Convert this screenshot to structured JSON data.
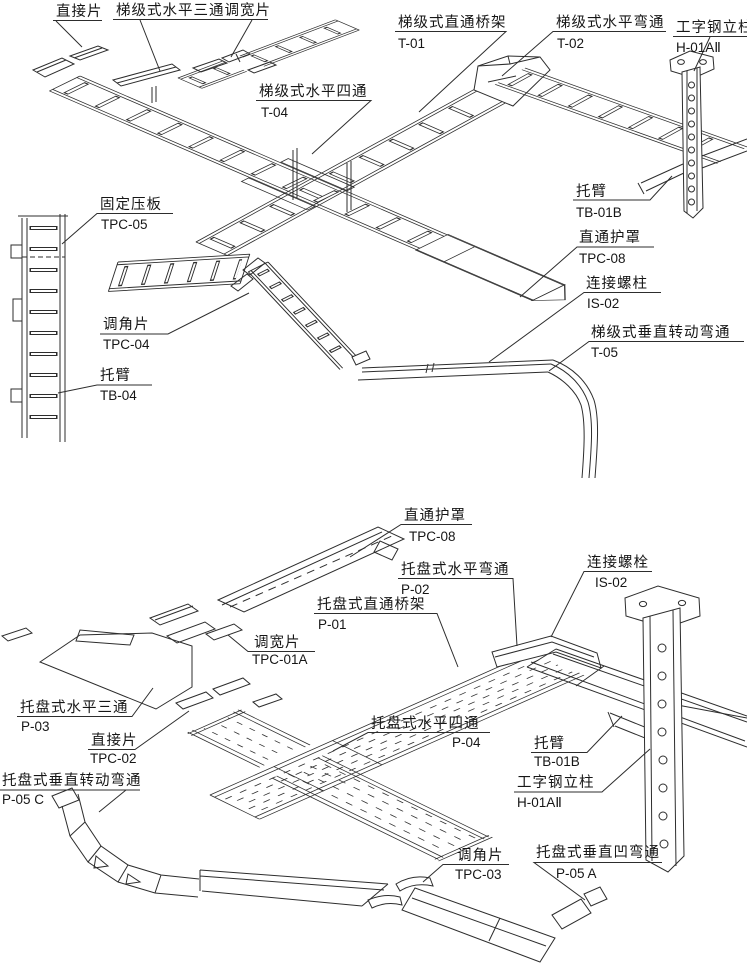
{
  "page": {
    "background_color": "#ffffff",
    "line_color": "#2d2d2d",
    "text_color": "#161616"
  },
  "top_drawing": {
    "type": "ladder-type cable tray assembly",
    "labels": {
      "connector_piece": {
        "name": "直接片",
        "code": ""
      },
      "tee_width_adjuster": {
        "name": "梯级式水平三通调宽片",
        "code": ""
      },
      "straight_tray": {
        "name": "梯级式直通桥架",
        "code": "T-01"
      },
      "horizontal_bend": {
        "name": "梯级式水平弯通",
        "code": "T-02"
      },
      "i_beam_column": {
        "name": "工字钢立柱",
        "code": "H-01AⅡ"
      },
      "horizontal_cross": {
        "name": "梯级式水平四通",
        "code": "T-04"
      },
      "support_arm_b": {
        "name": "托臂",
        "code": "TB-01B"
      },
      "fixing_clamp_plate": {
        "name": "固定压板",
        "code": "TPC-05"
      },
      "straight_cover": {
        "name": "直通护罩",
        "code": "TPC-08"
      },
      "connecting_stud": {
        "name": "连接螺柱",
        "code": "IS-02"
      },
      "vertical_turning_bend": {
        "name": "梯级式垂直转动弯通",
        "code": "T-05"
      },
      "angle_adjuster": {
        "name": "调角片",
        "code": "TPC-04"
      },
      "support_arm": {
        "name": "托臂",
        "code": "TB-04"
      }
    }
  },
  "bottom_drawing": {
    "type": "tray-type cable tray assembly",
    "labels": {
      "straight_cover": {
        "name": "直通护罩",
        "code": "TPC-08"
      },
      "horizontal_bend": {
        "name": "托盘式水平弯通",
        "code": "P-02"
      },
      "straight_tray": {
        "name": "托盘式直通桥架",
        "code": "P-01"
      },
      "connecting_bolt": {
        "name": "连接螺栓",
        "code": "IS-02"
      },
      "width_adjuster": {
        "name": "调宽片",
        "code": "TPC-01A"
      },
      "horizontal_tee": {
        "name": "托盘式水平三通",
        "code": "P-03"
      },
      "connector_piece": {
        "name": "直接片",
        "code": "TPC-02"
      },
      "vertical_turning_bend": {
        "name": "托盘式垂直转动弯通",
        "code": "P-05 C"
      },
      "horizontal_cross": {
        "name": "托盘式水平四通",
        "code": "P-04"
      },
      "support_arm": {
        "name": "托臂",
        "code": "TB-01B"
      },
      "i_beam_column": {
        "name": "工字钢立柱",
        "code": "H-01AⅡ"
      },
      "angle_adjuster": {
        "name": "调角片",
        "code": "TPC-03"
      },
      "vertical_concave_bend": {
        "name": "托盘式垂直凹弯通",
        "code": "P-05 A"
      }
    }
  }
}
